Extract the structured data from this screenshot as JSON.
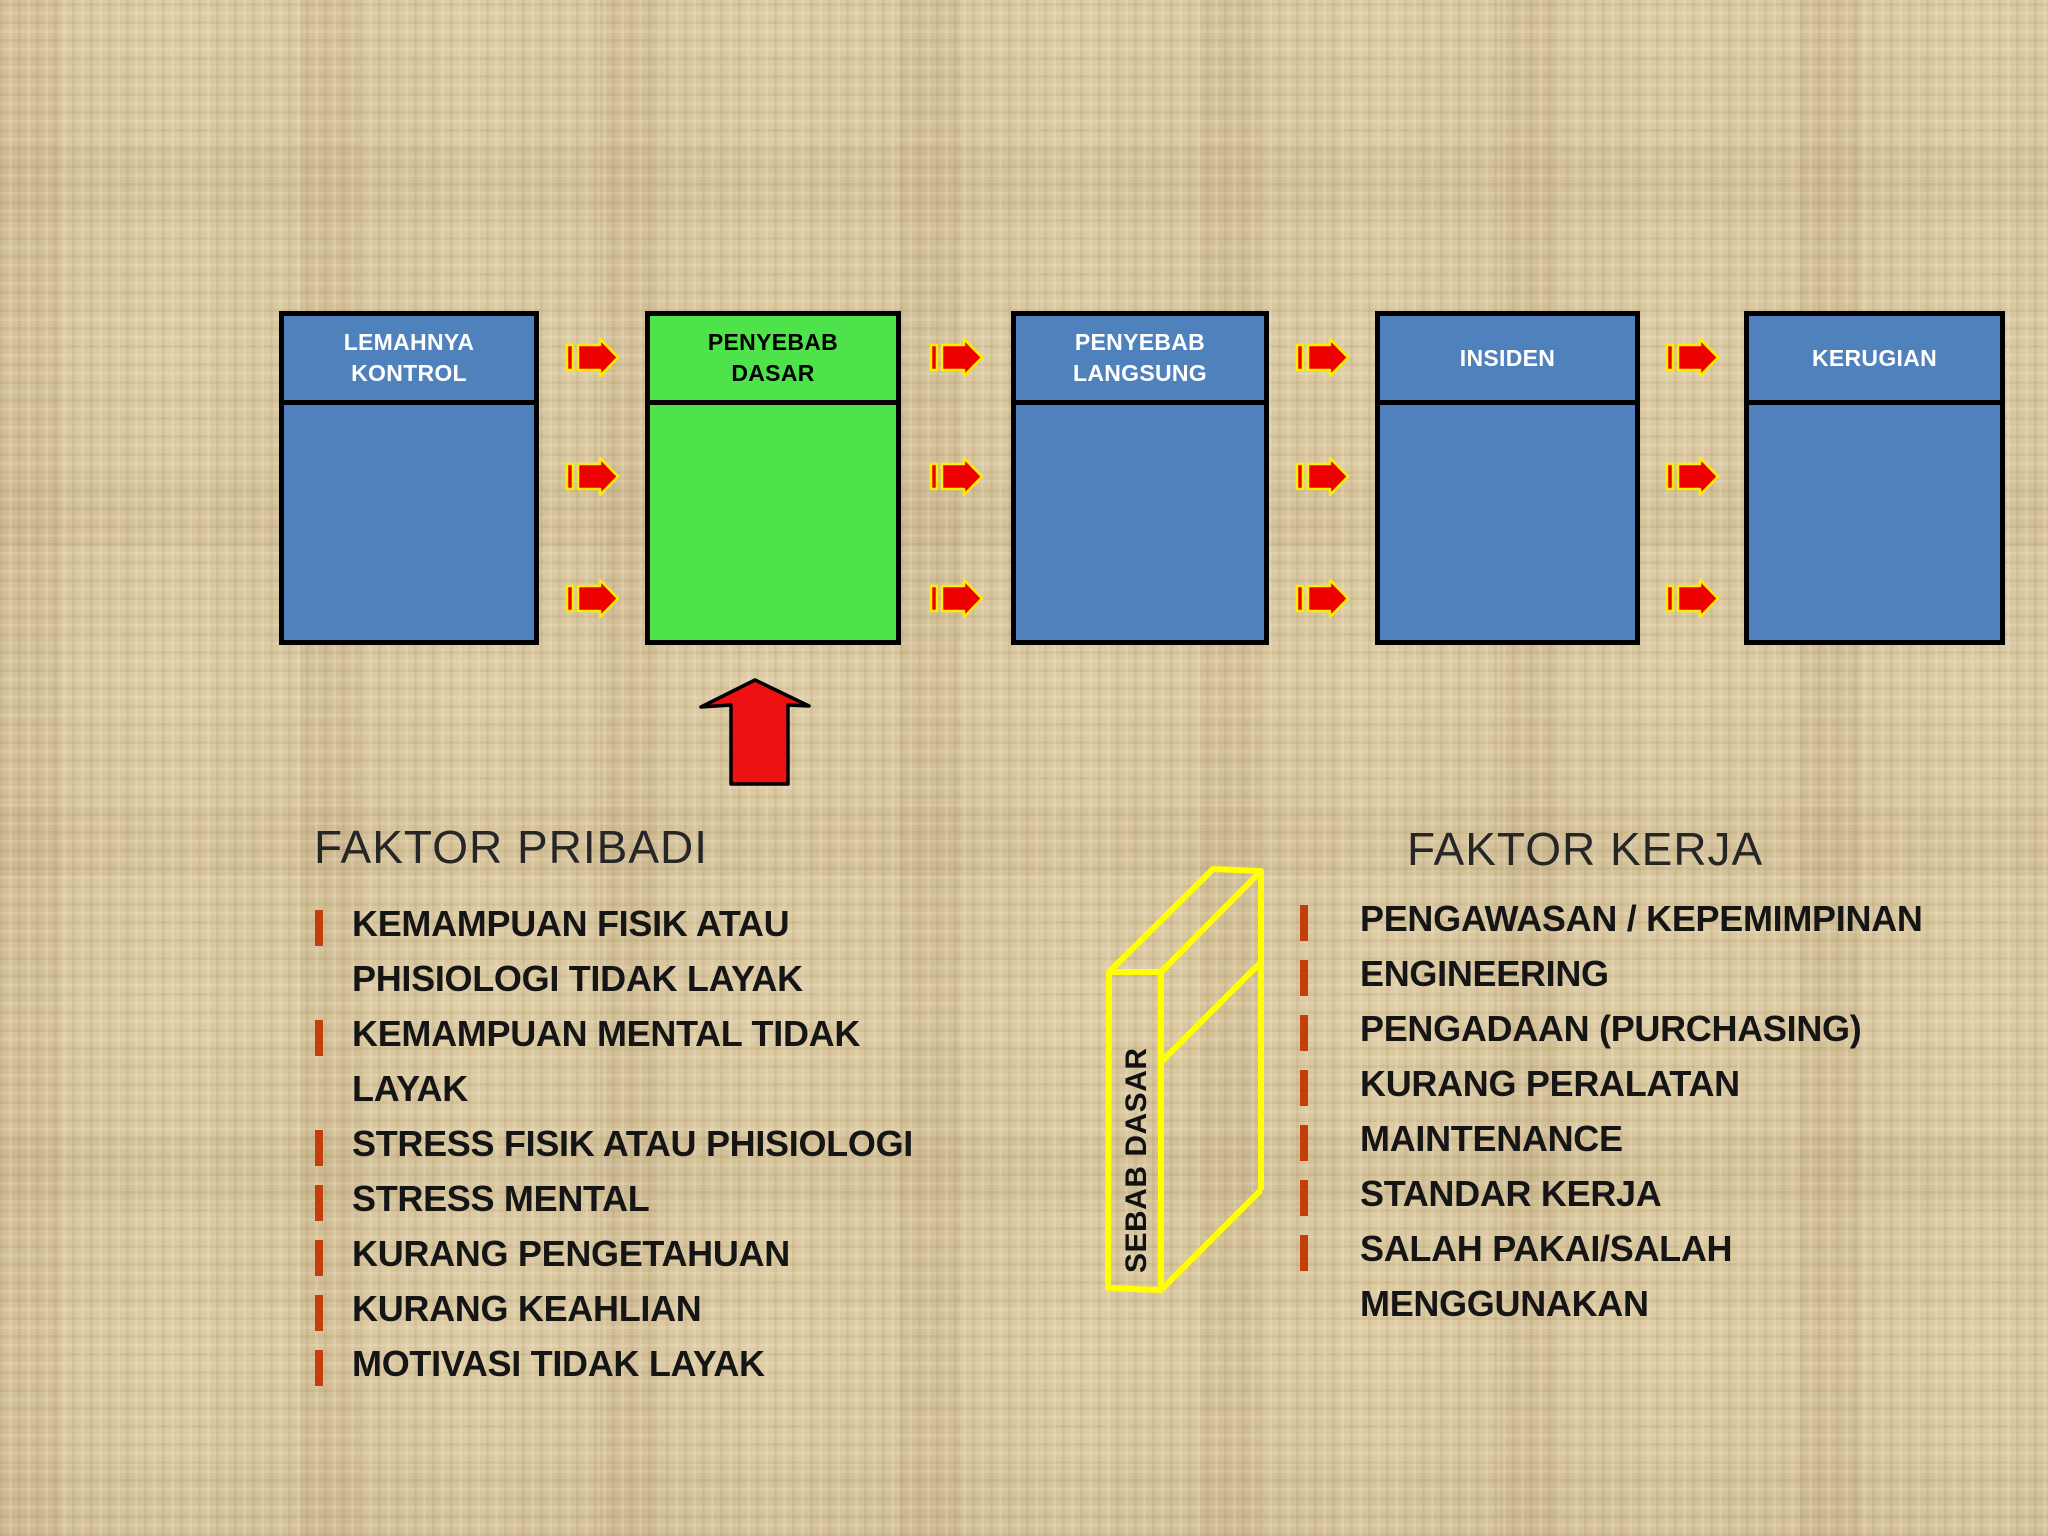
{
  "slide": {
    "flow_boxes": [
      {
        "line1": "LEMAHNYA",
        "line2": "KONTROL"
      },
      {
        "line1": "PENYEBAB",
        "line2": "DASAR"
      },
      {
        "line1": "PENYEBAB",
        "line2": "LANGSUNG"
      },
      {
        "line1": "INSIDEN",
        "line2": ""
      },
      {
        "line1": "KERUGIAN",
        "line2": ""
      }
    ],
    "cube": {
      "label": "SEBAB DASAR"
    },
    "left_section": {
      "title": "FAKTOR PRIBADI",
      "items": [
        {
          "bullet": true,
          "text": "KEMAMPUAN FISIK ATAU"
        },
        {
          "bullet": false,
          "text": "PHISIOLOGI TIDAK LAYAK"
        },
        {
          "bullet": true,
          "text": "KEMAMPUAN MENTAL TIDAK"
        },
        {
          "bullet": false,
          "text": "LAYAK"
        },
        {
          "bullet": true,
          "text": "STRESS FISIK ATAU PHISIOLOGI"
        },
        {
          "bullet": true,
          "text": "STRESS MENTAL"
        },
        {
          "bullet": true,
          "text": "KURANG PENGETAHUAN"
        },
        {
          "bullet": true,
          "text": "KURANG KEAHLIAN"
        },
        {
          "bullet": true,
          "text": "MOTIVASI TIDAK LAYAK"
        }
      ]
    },
    "right_section": {
      "title": "FAKTOR KERJA",
      "items": [
        {
          "bullet": true,
          "text": "PENGAWASAN / KEPEMIMPINAN"
        },
        {
          "bullet": true,
          "text": "ENGINEERING"
        },
        {
          "bullet": true,
          "text": "PENGADAAN (PURCHASING)"
        },
        {
          "bullet": true,
          "text": "KURANG PERALATAN"
        },
        {
          "bullet": true,
          "text": "MAINTENANCE"
        },
        {
          "bullet": true,
          "text": "STANDAR KERJA"
        },
        {
          "bullet": true,
          "text": "SALAH PAKAI/SALAH"
        },
        {
          "bullet": false,
          "text": "MENGGUNAKAN"
        }
      ]
    },
    "icons": {
      "between_boxes": "striped-right-arrow",
      "under_basic_cause_box": "block-up-arrow"
    },
    "colors": {
      "background_tan": "#D9C7A0",
      "box_blue": "#4F81BD",
      "box_green": "#4EE24B",
      "box_border_black": "#000000",
      "box_text_white": "#FFFFFF",
      "arrow_red": "#EE0000",
      "arrow_outline_yellow": "#FFEE00",
      "up_arrow_red": "#ED1111",
      "cube_outline_yellow": "#FFFF00",
      "bullet_orange": "#C43E0C",
      "body_text_black": "#151515"
    }
  }
}
